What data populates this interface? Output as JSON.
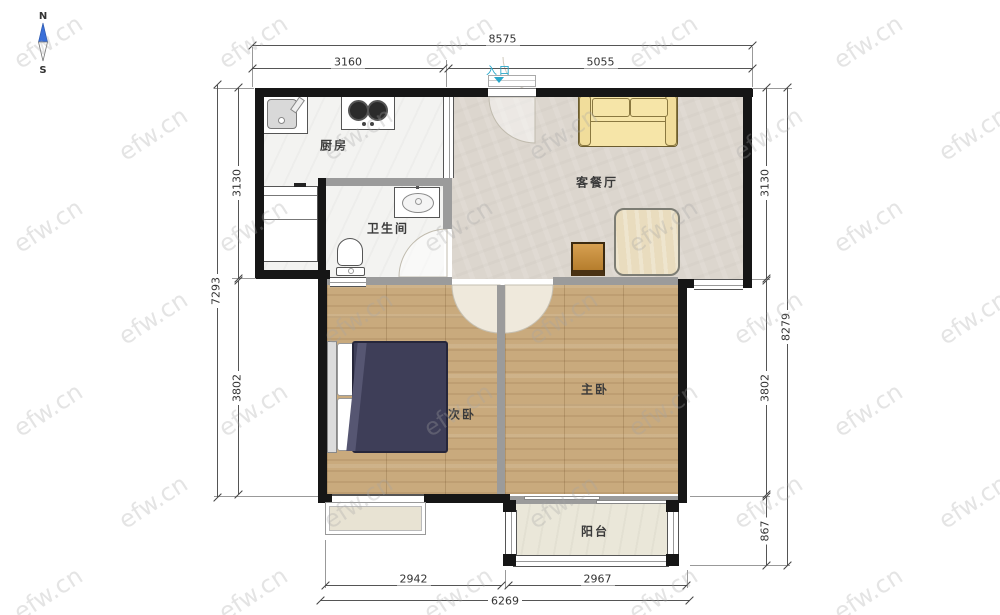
{
  "watermark": {
    "text": "efw.cn"
  },
  "compass": {
    "north_label": "N",
    "south_label": "S"
  },
  "entrance": {
    "label": "入口"
  },
  "rooms": {
    "kitchen": {
      "label": "厨房"
    },
    "bathroom": {
      "label": "卫生间"
    },
    "living_dining": {
      "label": "客餐厅"
    },
    "second_bedroom": {
      "label": "次卧"
    },
    "master_bedroom": {
      "label": "主卧"
    },
    "balcony": {
      "label": "阳台"
    }
  },
  "dimensions_mm": {
    "top": {
      "overall": "8575",
      "kitchen_width": "3160",
      "living_width": "5055"
    },
    "left": {
      "overall": "7293",
      "upper": "3130",
      "lower": "3802"
    },
    "right": {
      "overall": "8279",
      "upper": "3130",
      "middle": "3802",
      "balcony": "867"
    },
    "bottom": {
      "overall": "6269",
      "left": "2942",
      "right": "2967"
    }
  },
  "colors": {
    "wall": "#161616",
    "iwall": "#9b9b9b",
    "wood": "#c9aa7d",
    "living": "#dcd6ce",
    "tile": "#f3f3f1",
    "balcony": "#eae7d9",
    "sofa": "#f6e5a8",
    "table": "#e9dcbe",
    "chair": "#cf8f33",
    "blanket": "#3e3e58",
    "accent": "#2aa7c9",
    "compass_north": "#3a6fd8"
  }
}
